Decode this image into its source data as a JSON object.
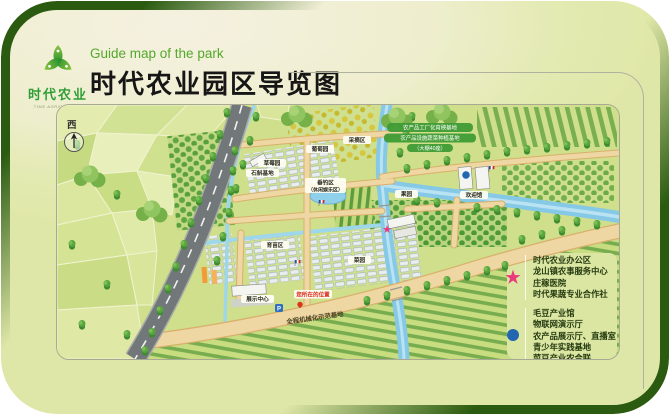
{
  "header": {
    "logo_text": "时代农业",
    "logo_subtext": "TIME AGRICULTURE",
    "subtitle_en": "Guide map of the park",
    "title": "时代农业园区导览图"
  },
  "map": {
    "compass_label": "西",
    "labels": {
      "grape": "葡萄园",
      "strawberry": "草莓园",
      "dendrobium": "石斛基地",
      "picking": "采摘区",
      "fishing_line1": "垂钓区",
      "fishing_line2": "（休闲娱乐区）",
      "orchard": "果园",
      "seedling": "育苗区",
      "vegetable": "菜园",
      "exhibition_center": "展示中心",
      "you_are_here": "您所在的位置",
      "road_name": "全程机械化示范基地",
      "welcome_hall": "欢迎馆",
      "green_pill_1": "农产品工厂化育秧基地",
      "green_pill_2": "农产品设施蔬菜种植基地",
      "green_pill_3": "（大棚40座）",
      "parking": "P"
    },
    "legend": {
      "star_color": "#ea3a7c",
      "dot_color": "#2166ae",
      "star_items": [
        "时代农业办公区",
        "龙山镇农事服务中心",
        "庄稼医院",
        "时代果蔬专业合作社"
      ],
      "dot_items": [
        "毛豆产业馆",
        "物联网演示厅",
        "农产品展示厅、直播室",
        "青少年实践基地",
        "菜豆产业农合联"
      ]
    }
  },
  "colors": {
    "frame_green": "#2b5b10",
    "card_cream": "#f5f1e1",
    "card_green": "#dfe7a8",
    "title_green": "#54a82c",
    "river_blue": "#85c9e6",
    "road_gray": "#72777a",
    "path_tan": "#eed7a2"
  }
}
